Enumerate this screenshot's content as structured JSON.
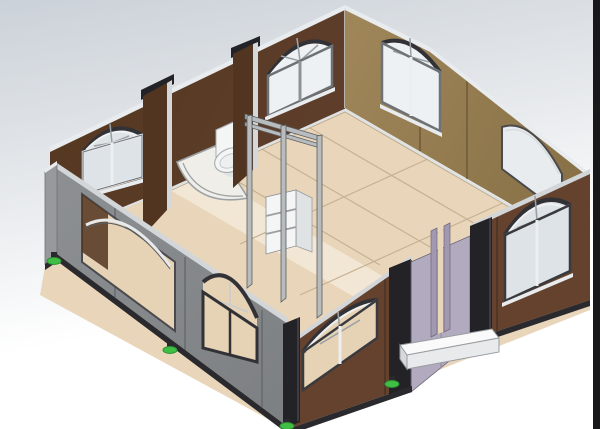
{
  "scene": {
    "title": "3D CAD isometric render of an expandable container house, open-top view showing interior",
    "render_style": "solidworks-like shaded model",
    "elements": [
      "back-left brown wall with two arched windows",
      "back-right khaki wall with arched window and arched open cutout",
      "front-right brown wall with two arched windows and entry door recess",
      "front-left gray wing wall with open window and framed arched window",
      "left gray end wall",
      "tan plywood floor with panel seams",
      "bathroom with toilet and curved shower tray",
      "dark brown bathroom partition panels",
      "interior stud door frame",
      "white shelf unit",
      "lavender entry door with U-channel",
      "white entry step",
      "black corner posts and base rails",
      "green leveling feet",
      "dark strip along right image edge"
    ]
  },
  "colors": {
    "bg_top": "#cbd1d8",
    "bg_mid": "#e6e9ec",
    "bg_bottom": "#ffffff",
    "edge_strip": "#18181b",
    "wall_brown": "#5e3e2b",
    "wall_brown_dark": "#523520",
    "wall_brown_front": "#64422e",
    "wall_khaki": "#a0875a",
    "wall_khaki_dark": "#8a7248",
    "wall_gray": "#8d9092",
    "wall_gray_dark": "#7e8183",
    "end_wall_gray": "#97999c",
    "floor": "#e9d6ba",
    "floor_light": "#f3e9d8",
    "floor_seam": "#c7b193",
    "cap_white": "#e9ecee",
    "cap_gray": "#d3d6d8",
    "post_black": "#232327",
    "rail_black": "#2a2a2e",
    "door_lavender": "#b2aabf",
    "door_lavender_dark": "#a199b1",
    "green_foot": "#3fbf44",
    "fixture_white": "#f4f6f6",
    "fixture_shade": "#dfe3e4",
    "glass_sky": "#dde3e7",
    "glass_bright": "#eef1f3",
    "glass_tan": "#e6d2b4",
    "frame_white": "#f0f1f2",
    "trim_dark": "#323236",
    "stud_gray": "#b8bcbe",
    "step_white": "#fafafa",
    "step_shade": "#e9eaeb",
    "cutout_sky": "#e9ecee"
  }
}
